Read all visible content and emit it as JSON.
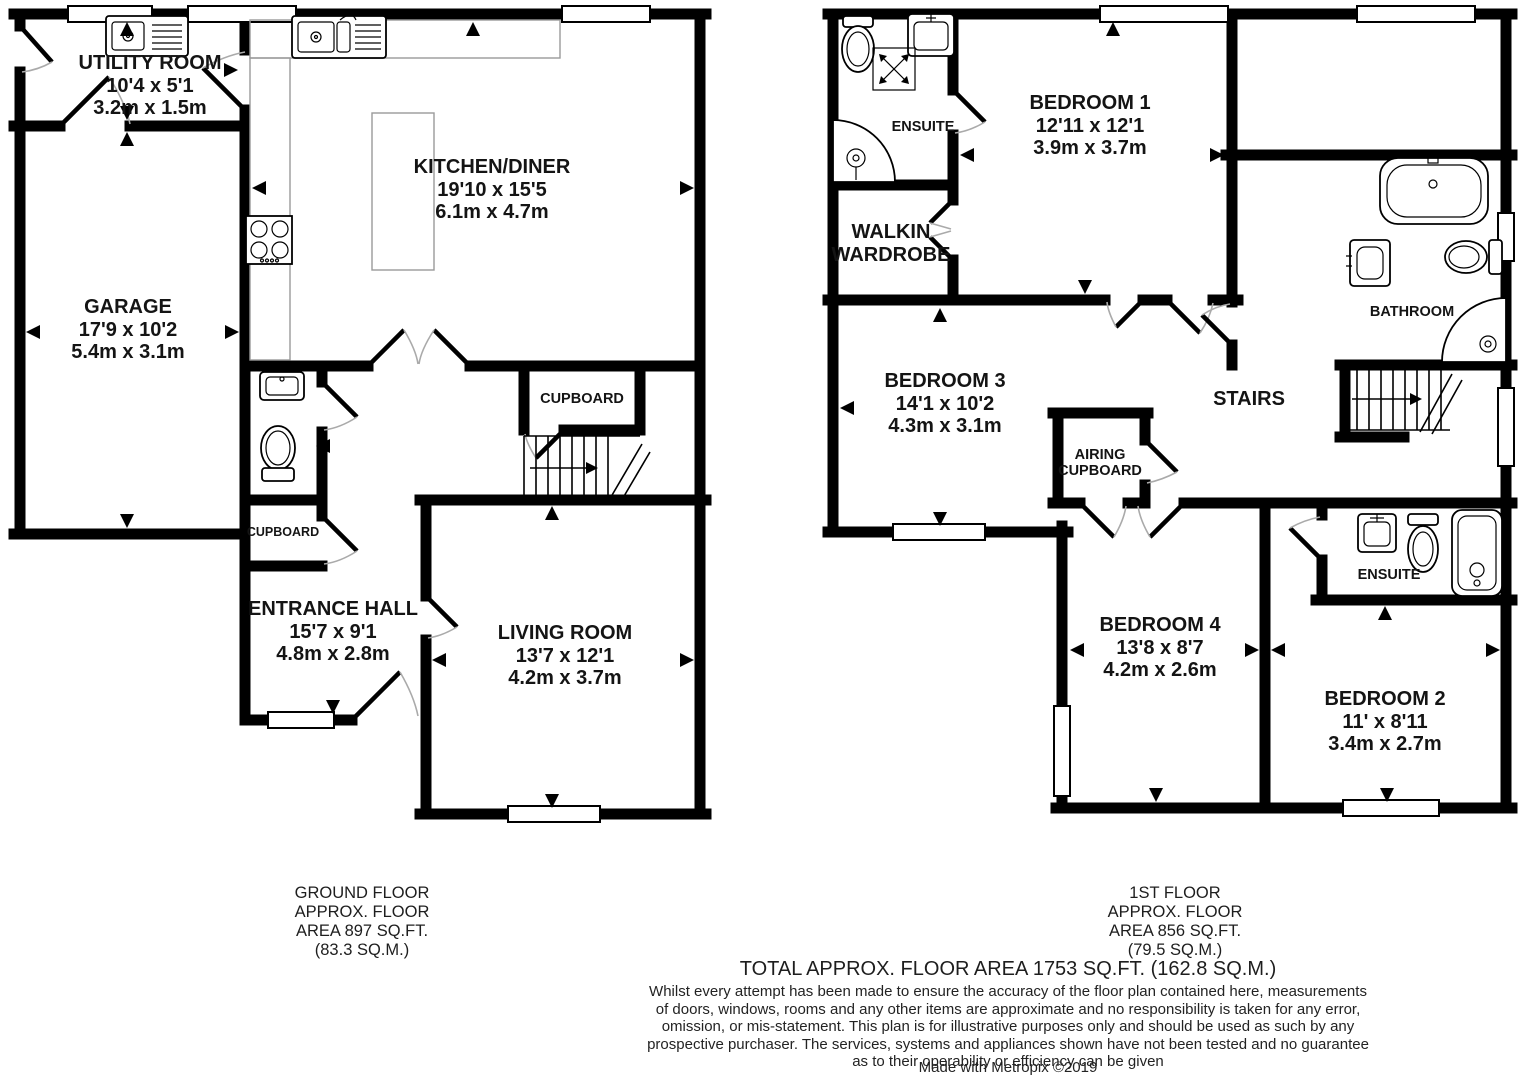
{
  "ground_floor": {
    "caption_lines": [
      "GROUND FLOOR",
      "APPROX. FLOOR",
      "AREA 897 SQ.FT.",
      "(83.3 SQ.M.)"
    ],
    "rooms": {
      "utility": {
        "name": "UTILITY ROOM",
        "dims_ft": "10'4 x 5'1",
        "dims_m": "3.2m x 1.5m"
      },
      "kitchen_diner": {
        "name": "KITCHEN/DINER",
        "dims_ft": "19'10 x 15'5",
        "dims_m": "6.1m x 4.7m"
      },
      "garage": {
        "name": "GARAGE",
        "dims_ft": "17'9 x 10'2",
        "dims_m": "5.4m x 3.1m"
      },
      "entrance_hall": {
        "name": "ENTRANCE HALL",
        "dims_ft": "15'7 x 9'1",
        "dims_m": "4.8m x 2.8m"
      },
      "living_room": {
        "name": "LIVING ROOM",
        "dims_ft": "13'7 x 12'1",
        "dims_m": "4.2m x 3.7m"
      },
      "cupboard_upper": {
        "name": "CUPBOARD"
      },
      "cupboard_lower": {
        "name": "CUPBOARD"
      }
    }
  },
  "first_floor": {
    "caption_lines": [
      "1ST FLOOR",
      "APPROX. FLOOR",
      "AREA 856 SQ.FT.",
      "(79.5 SQ.M.)"
    ],
    "rooms": {
      "ensuite_1": {
        "name": "ENSUITE"
      },
      "walkin_wardrobe": {
        "name": "WALKIN WARDROBE"
      },
      "bedroom_1": {
        "name": "BEDROOM 1",
        "dims_ft": "12'11 x 12'1",
        "dims_m": "3.9m x 3.7m"
      },
      "bedroom_3": {
        "name": "BEDROOM 3",
        "dims_ft": "14'1 x 10'2",
        "dims_m": "4.3m x 3.1m"
      },
      "airing_cupboard": {
        "name": "AIRING CUPBOARD"
      },
      "stairs": {
        "name": "STAIRS"
      },
      "bathroom": {
        "name": "BATHROOM"
      },
      "bedroom_4": {
        "name": "BEDROOM 4",
        "dims_ft": "13'8 x 8'7",
        "dims_m": "4.2m x 2.6m"
      },
      "bedroom_2": {
        "name": "BEDROOM 2",
        "dims_ft": "11' x 8'11",
        "dims_m": "3.4m x 2.7m"
      },
      "ensuite_2": {
        "name": "ENSUITE"
      }
    }
  },
  "footer": {
    "total_area": "TOTAL APPROX. FLOOR AREA 1753 SQ.FT. (162.8 SQ.M.)",
    "disclaimer_lines": [
      "Whilst every attempt has been made to ensure the accuracy of the floor plan contained here, measurements",
      "of doors, windows, rooms and any other items are approximate and no responsibility is taken for any error,",
      "omission, or mis-statement. This plan is for illustrative purposes only and should be used as such by any",
      "prospective purchaser. The services, systems and appliances shown have not been tested and no guarantee",
      "as to their operability or efficiency can be given"
    ],
    "credit": "Made with Metropix ©2019"
  }
}
